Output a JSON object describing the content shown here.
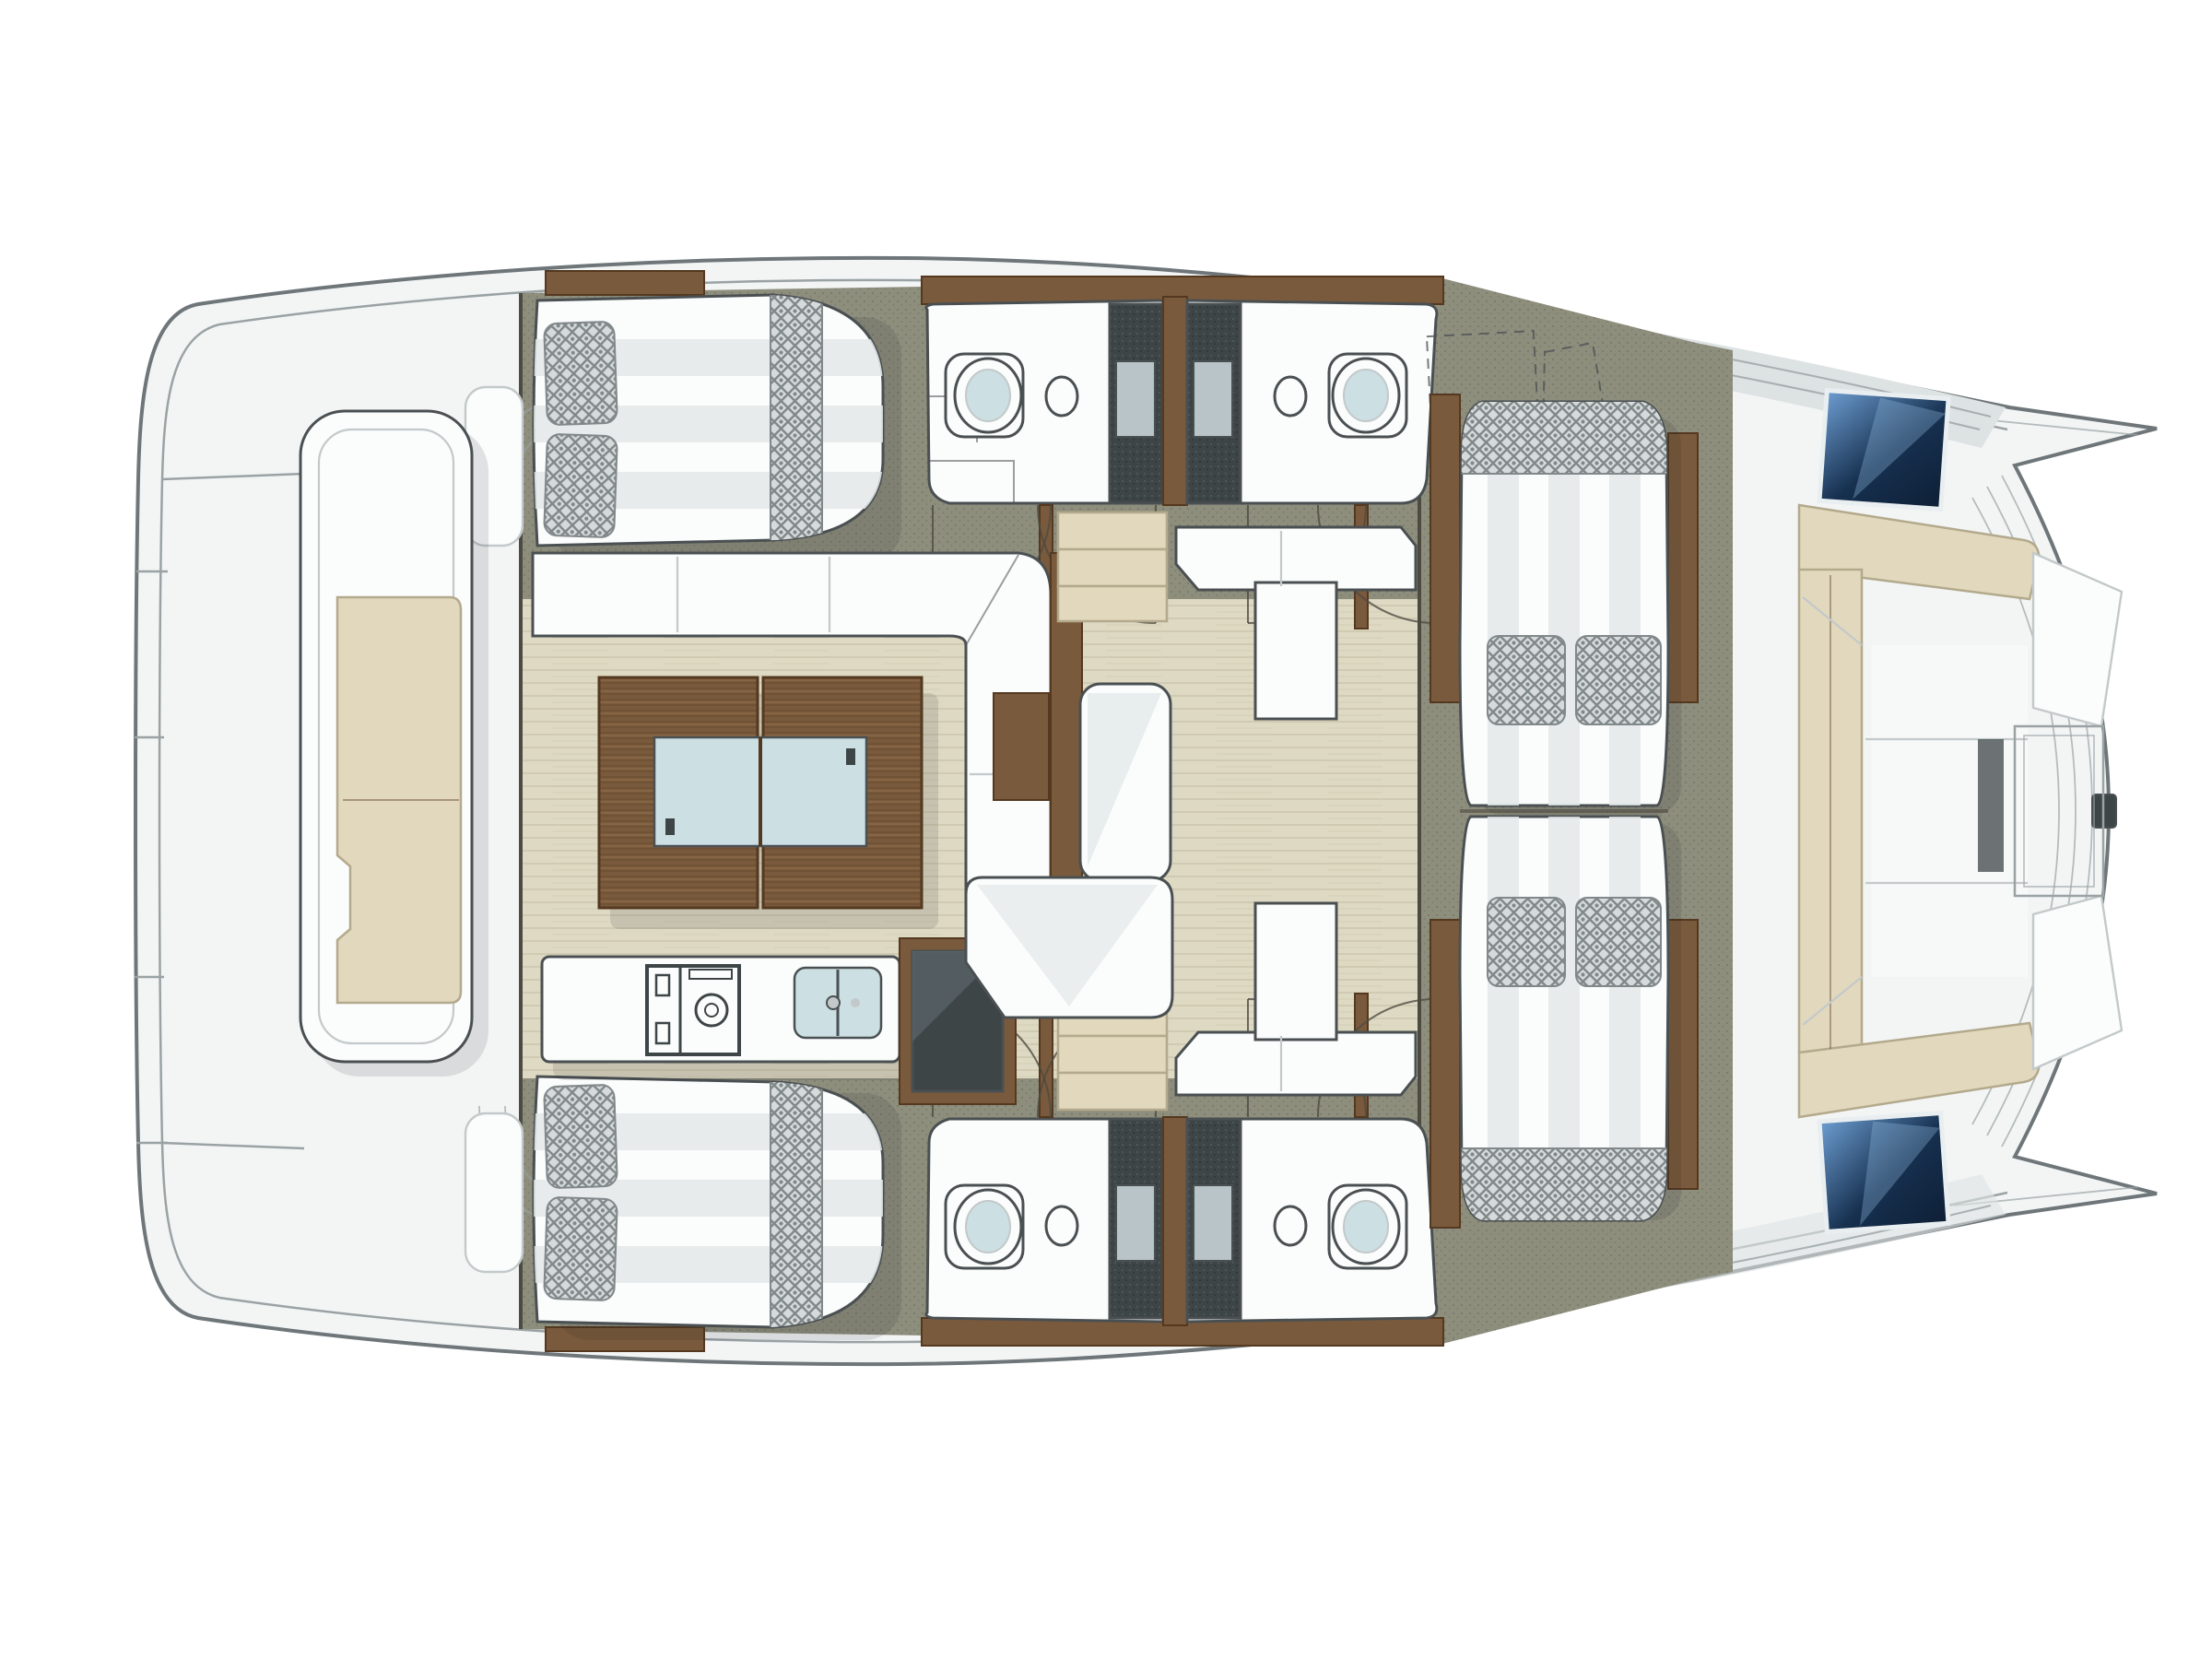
{
  "document": {
    "title": "Catamaran deck layout — top-down floor plan"
  },
  "palette": {
    "page": "#ffffff",
    "hullFill": "#f3f5f5",
    "hullLine": "#6e7679",
    "innerLine": "#9aa2a4",
    "roofBand": "#dde2e3",
    "olive": "#8e8e7d",
    "oliveDot": "#76766a",
    "woodFloor": "#ded9c3",
    "woodFloorLine": "#ccc6ac",
    "wallDark": "#4d4a41",
    "wood": "#7a5a3c",
    "woodDark": "#54381f",
    "woodLight": "#96724e",
    "white": "#fbfcfc",
    "whiteShade": "#c3c9ca",
    "furnLine": "#4a5052",
    "stripe": "#e3e8e9",
    "chBg": "#d6dada",
    "chLine": "#81888a",
    "charcoal": "#3e4547",
    "charcoalHi": "#b8c4c8",
    "beige": "#e2d8bd",
    "beigeEdge": "#b3a98c",
    "glass": "#ccdfe3",
    "blue1": "#6e9ed2",
    "blue2": "#16304f",
    "blueDark": "#0e1f35",
    "shadow": "#1f2426"
  },
  "boat": {
    "type": "catamaran",
    "view": "top-down deck plan",
    "bow": "right",
    "stern": "left"
  },
  "rooms": {
    "aft_deck": {
      "name": "Aft deck with transom lounge bench"
    },
    "upper_cabin": {
      "name": "Double berth cabin, upper hull aft"
    },
    "lower_cabin": {
      "name": "Double berth cabin, lower hull aft"
    },
    "upper_bath_aft": {
      "name": "Bathroom upper hull aft: toilet, washbasin, shower"
    },
    "upper_bath_fwd": {
      "name": "Bathroom upper hull forward: toilet, washbasin, shower"
    },
    "lower_bath_aft": {
      "name": "Bathroom lower hull aft: toilet, washbasin, shower"
    },
    "lower_bath_fwd": {
      "name": "Bathroom lower hull forward: toilet, washbasin, shower"
    },
    "salon_dining": {
      "name": "Salon dining area with L-shaped sofa and wooden table"
    },
    "galley": {
      "name": "Galley with cooktop, twin sink and refrigerator"
    },
    "lounge": {
      "name": "Salon lounge with settees, chaise and coffee table"
    },
    "sunpads": {
      "name": "Twin striped sun pads with cushions"
    },
    "bow_cockpit": {
      "name": "Forward cockpit with C-shaped bench seating"
    },
    "foredeck": {
      "name": "Bow platform with tinted deck hatches"
    },
    "helm": {
      "name": "Helm station, shown dashed (upper deck)"
    }
  },
  "furniture": {
    "transom_bench": "Transom bench with beige cushion",
    "bed": "Double bed with two quilted pillows and runner",
    "toilet": "Marine toilet",
    "basin": "Washbasin",
    "shower": "Shower stall with sliding door",
    "dining_sofa": "L-shaped dining sofa",
    "dining_table": "Two-leaf wooden dining table with glass insert",
    "cooktop": "Two-burner cooktop",
    "galley_sink": "Twin galley sink",
    "fridge": "Refrigerator / oven unit",
    "steps": "Three-tread companionway steps",
    "settee": "Corner settee",
    "chaise": "Chaise seat",
    "lounge_sofa": "Lounge sofa",
    "coffee_table": "Wooden coffee table",
    "sun_pad": "Striped sun pad with two quilted cushions",
    "bow_bench": "Beige C-shaped bow bench",
    "deck_hatch": "Tinted deck hatch",
    "helm_seat": "Helm seat (dashed)"
  },
  "counts": {
    "cabins": 2,
    "double_beds": 2,
    "bathrooms": 4,
    "toilets": 4,
    "washbasins": 4,
    "showers": 4,
    "sun_pads": 2,
    "deck_hatches": 2,
    "door_swings": 8,
    "step_flights": 2
  }
}
